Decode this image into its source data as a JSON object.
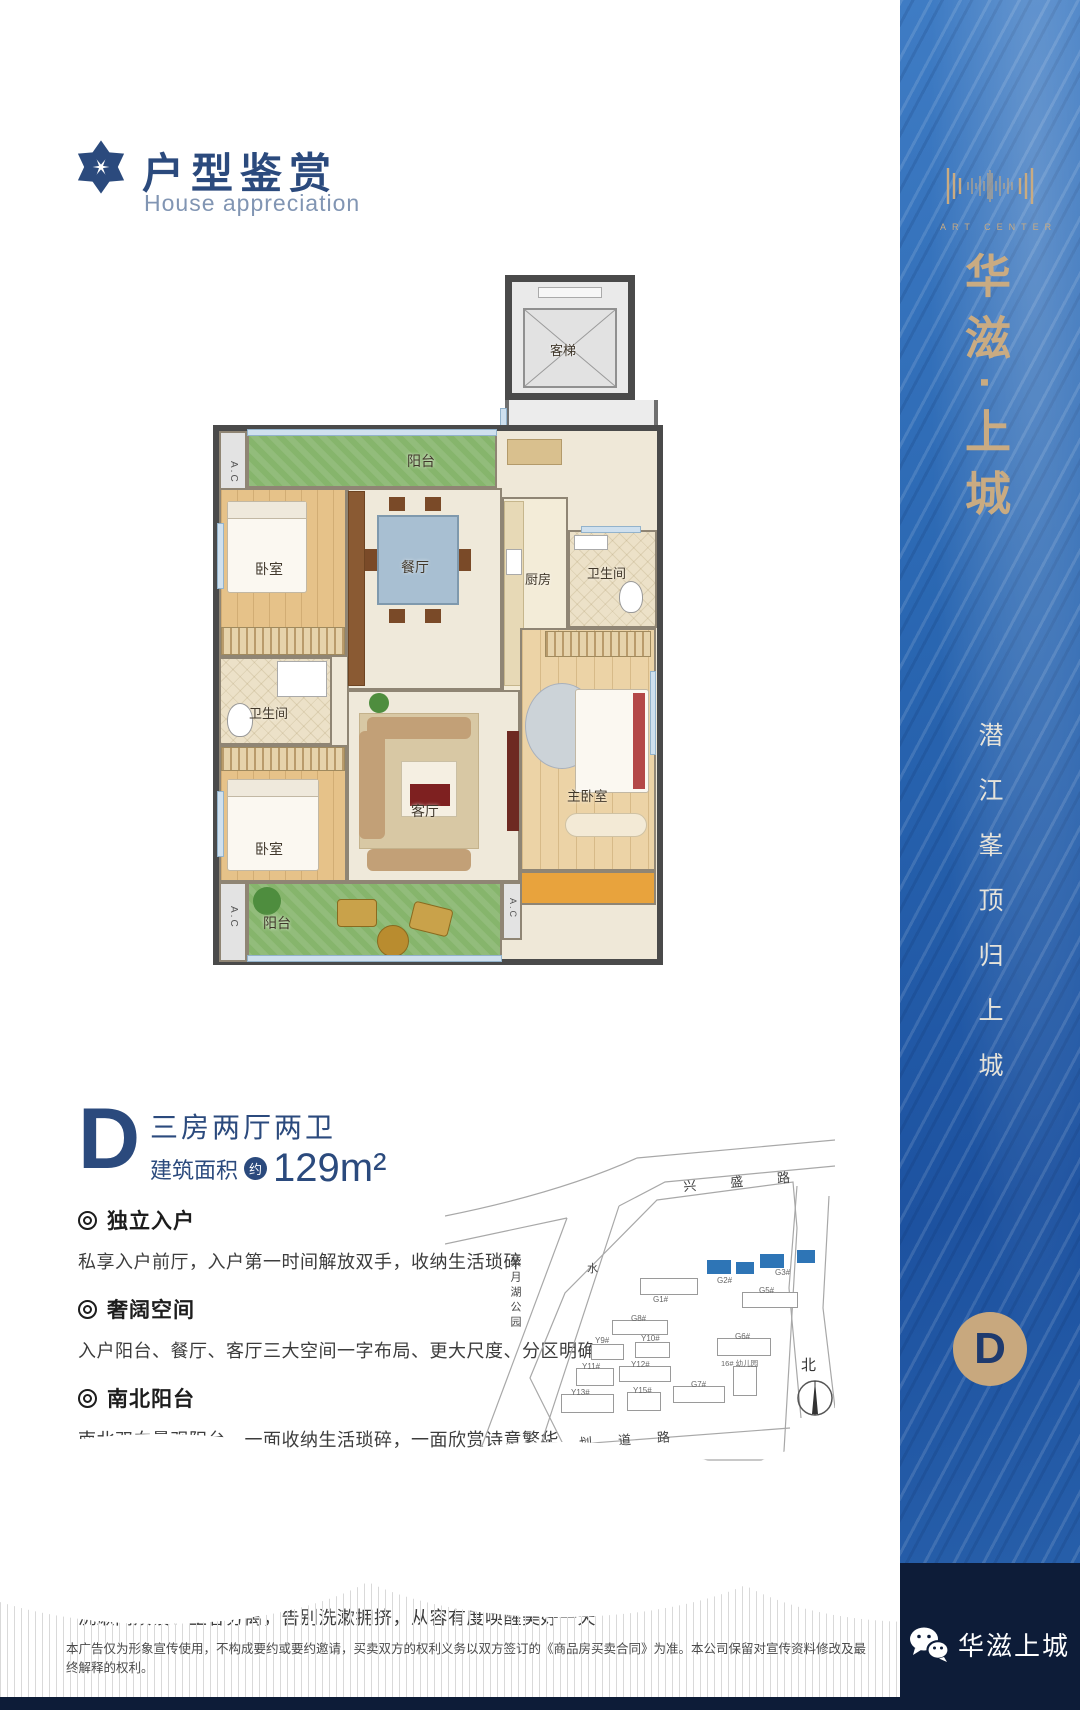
{
  "header": {
    "title": "户型鉴赏",
    "subtitle": "House appreciation"
  },
  "floorplan": {
    "elevator": "客梯",
    "elevator_hall": "电梯厅",
    "balcony": "阳台",
    "bedroom": "卧室",
    "dining": "餐厅",
    "kitchen": "厨房",
    "bathroom": "卫生间",
    "living": "客厅",
    "master_bedroom": "主卧室",
    "ac": "A.C"
  },
  "unit": {
    "letter": "D",
    "layout": "三房两厅两卫",
    "area_label": "建筑面积",
    "area_circle": "约",
    "area_value": "129m²"
  },
  "features": [
    {
      "title": "独立入户",
      "desc": "私享入户前厅，入户第一时间解放双手，收纳生活琐碎"
    },
    {
      "title": "奢阔空间",
      "desc": "入户阳台、餐厅、客厅三大空间一字布局、更大尺度、分区明确"
    },
    {
      "title": "南北阳台",
      "desc": "南北双向景观阳台，一面收纳生活琐碎，一面欣赏诗意繁华"
    },
    {
      "title": "套房主卧",
      "desc": "主卧配独立洗漱间、独立衣帽间、惬意观景飘窗，静享尊贵生活"
    },
    {
      "title": "明卫双设",
      "desc": "洗漱间双设、主客分离，告别洗漱拥挤，从容有度唤醒美好一天"
    }
  ],
  "sitemap": {
    "road_top": "兴盛路",
    "road_bottom": "规划道路",
    "road_left_char": "水",
    "park": "紫月湖公园",
    "north": "北",
    "buildings": [
      {
        "label": "G1#"
      },
      {
        "label": "G2#",
        "highlight": true
      },
      {
        "label": "G3#",
        "highlight": true
      },
      {
        "label": "G5#"
      },
      {
        "label": "G6#"
      },
      {
        "label": "G7#"
      },
      {
        "label": "G8#"
      },
      {
        "label": "Y9#"
      },
      {
        "label": "Y10#"
      },
      {
        "label": "Y11#"
      },
      {
        "label": "Y12#"
      },
      {
        "label": "Y13#"
      },
      {
        "label": "Y15#"
      },
      {
        "label": "16# 幼儿园"
      }
    ]
  },
  "disclaimer": "本广告仅为形象宣传使用，不构成要约或要约邀请，买卖双方的权利义务以双方签订的《商品房买卖合同》为准。本公司保留对宣传资料修改及最终解释的权利。",
  "sidebar": {
    "art_center": "ART CENTER",
    "brand": "华滋·上城",
    "slogan": "潜江峯顶归上城",
    "badge": "D",
    "footer_brand": "华滋上城"
  },
  "icons": {
    "header_logo": "star-flower-icon",
    "bullet": "bullseye-icon",
    "wechat": "wechat-icon",
    "compass": "north-compass-icon"
  },
  "colors": {
    "navy": "#2b4a7d",
    "gold": "#c9ab82",
    "sidebar_blue": "#2a67b2",
    "footer_navy": "#0d1c38",
    "highlight_building": "#2e75b6",
    "balcony_green": "#86b56c"
  }
}
